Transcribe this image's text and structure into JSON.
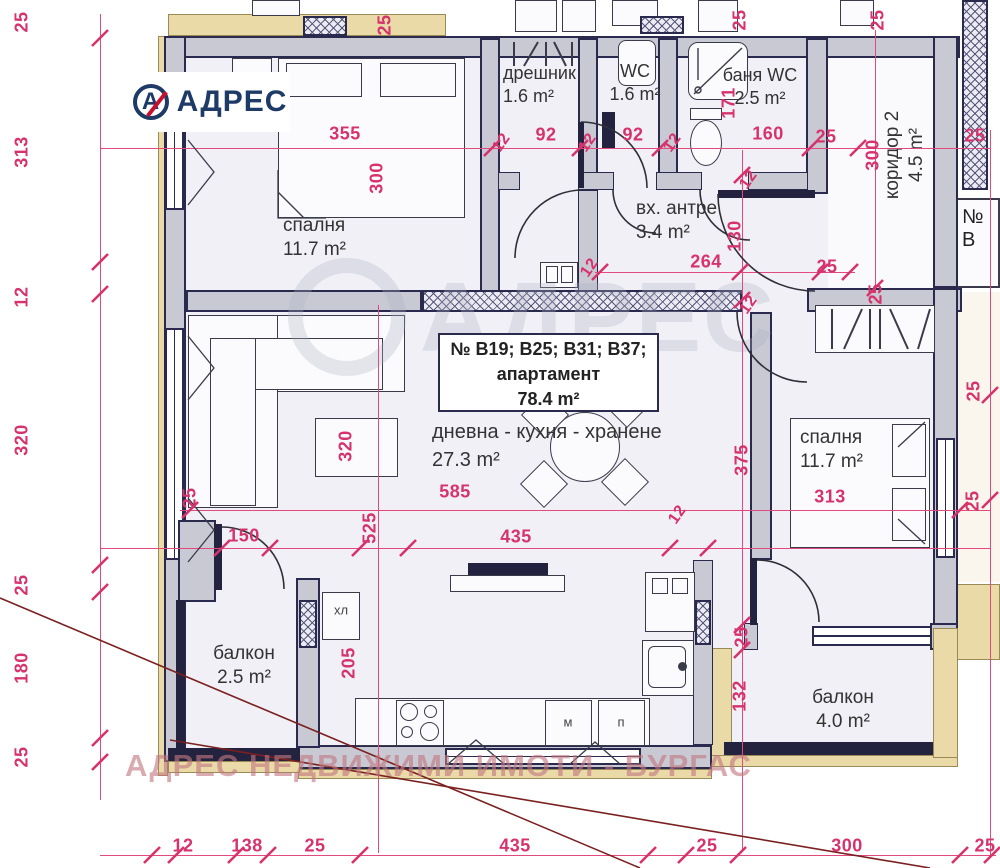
{
  "brand": {
    "logo_text": "АДРЕС",
    "logo_mark": "А"
  },
  "watermark": {
    "bottom": "АДРЕС НЕДВИЖИМИ ИМОТИ - БУРГАС",
    "ghost": "АДРЕС"
  },
  "unit_label": {
    "line1": "№ В19; В25; В31; В37;",
    "line2": "апартамент",
    "line3": "78.4 m²"
  },
  "neighbor_label": "№ В",
  "rooms": [
    {
      "name": "спалня",
      "area": "11.7 m²"
    },
    {
      "name": "дрешник",
      "area": "1.6 m²"
    },
    {
      "name": "WC",
      "area": "1.6 m²"
    },
    {
      "name": "баня WC",
      "area": "2.5 m²"
    },
    {
      "name": "вх. антре",
      "area": "3.4 m²"
    },
    {
      "name": "коридор 2",
      "area": "4.5 m²"
    },
    {
      "name": "дневна - кухня - хранене",
      "area": "27.3 m²"
    },
    {
      "name": "спалня",
      "area": "11.7 m²"
    },
    {
      "name": "балкон",
      "area": "2.5 m²"
    },
    {
      "name": "балкон",
      "area": "4.0 m²"
    }
  ],
  "appliances": {
    "fridge": "хл",
    "washer": "м",
    "dishwasher": "п"
  },
  "dims": [
    "25",
    "313",
    "12",
    "320",
    "25",
    "180",
    "25",
    "25",
    "355",
    "12",
    "92",
    "12",
    "92",
    "12",
    "160",
    "25",
    "25",
    "171",
    "300",
    "25",
    "25",
    "300",
    "12",
    "264",
    "130",
    "12",
    "25",
    "12",
    "25",
    "25",
    "25",
    "150",
    "525",
    "320",
    "585",
    "435",
    "12",
    "375",
    "313",
    "25",
    "205",
    "25",
    "132",
    "12",
    "138",
    "25",
    "435",
    "25",
    "300",
    "25"
  ]
}
